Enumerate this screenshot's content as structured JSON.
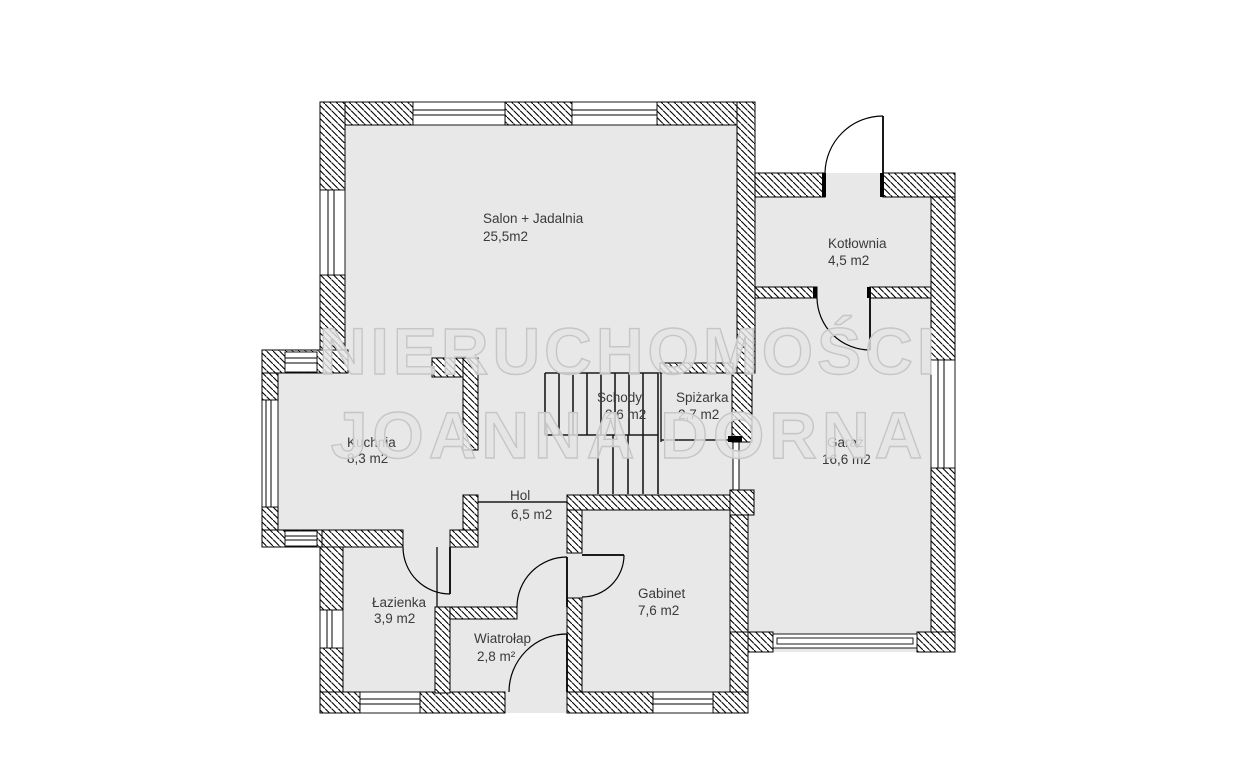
{
  "document": {
    "type": "floor-plan",
    "background_color": "#ffffff",
    "floor_color": "#e8e8e8",
    "wall_line_color": "#000000",
    "label_color": "#3a3a3a"
  },
  "watermark": {
    "line1": "NIERUCHOMOŚCI",
    "line2": "JOANNA DORNA",
    "fill_color": "#e4e4e4",
    "outline_color": "#c6c6c6"
  },
  "rooms": [
    {
      "id": "salon",
      "name": "Salon + Jadalnia",
      "area": "25,5m2"
    },
    {
      "id": "kotlownia",
      "name": "Kotłownia",
      "area": "4,5 m2"
    },
    {
      "id": "kuchnia",
      "name": "Kuchnia",
      "area": "8,3 m2"
    },
    {
      "id": "schody",
      "name": "Schody",
      "area": "2,6 m2"
    },
    {
      "id": "spizarka",
      "name": "Spiżarka",
      "area": "2,7 m2"
    },
    {
      "id": "garaz",
      "name": "Garaż",
      "area": "16,6 m2"
    },
    {
      "id": "hol",
      "name": "Hol",
      "area": "6,5 m2"
    },
    {
      "id": "lazienka",
      "name": "Łazienka",
      "area": "3,9 m2"
    },
    {
      "id": "gabinet",
      "name": "Gabinet",
      "area": "7,6 m2"
    },
    {
      "id": "wiatrolap",
      "name": "Wiatrołap",
      "area": "2,8 m²"
    }
  ]
}
